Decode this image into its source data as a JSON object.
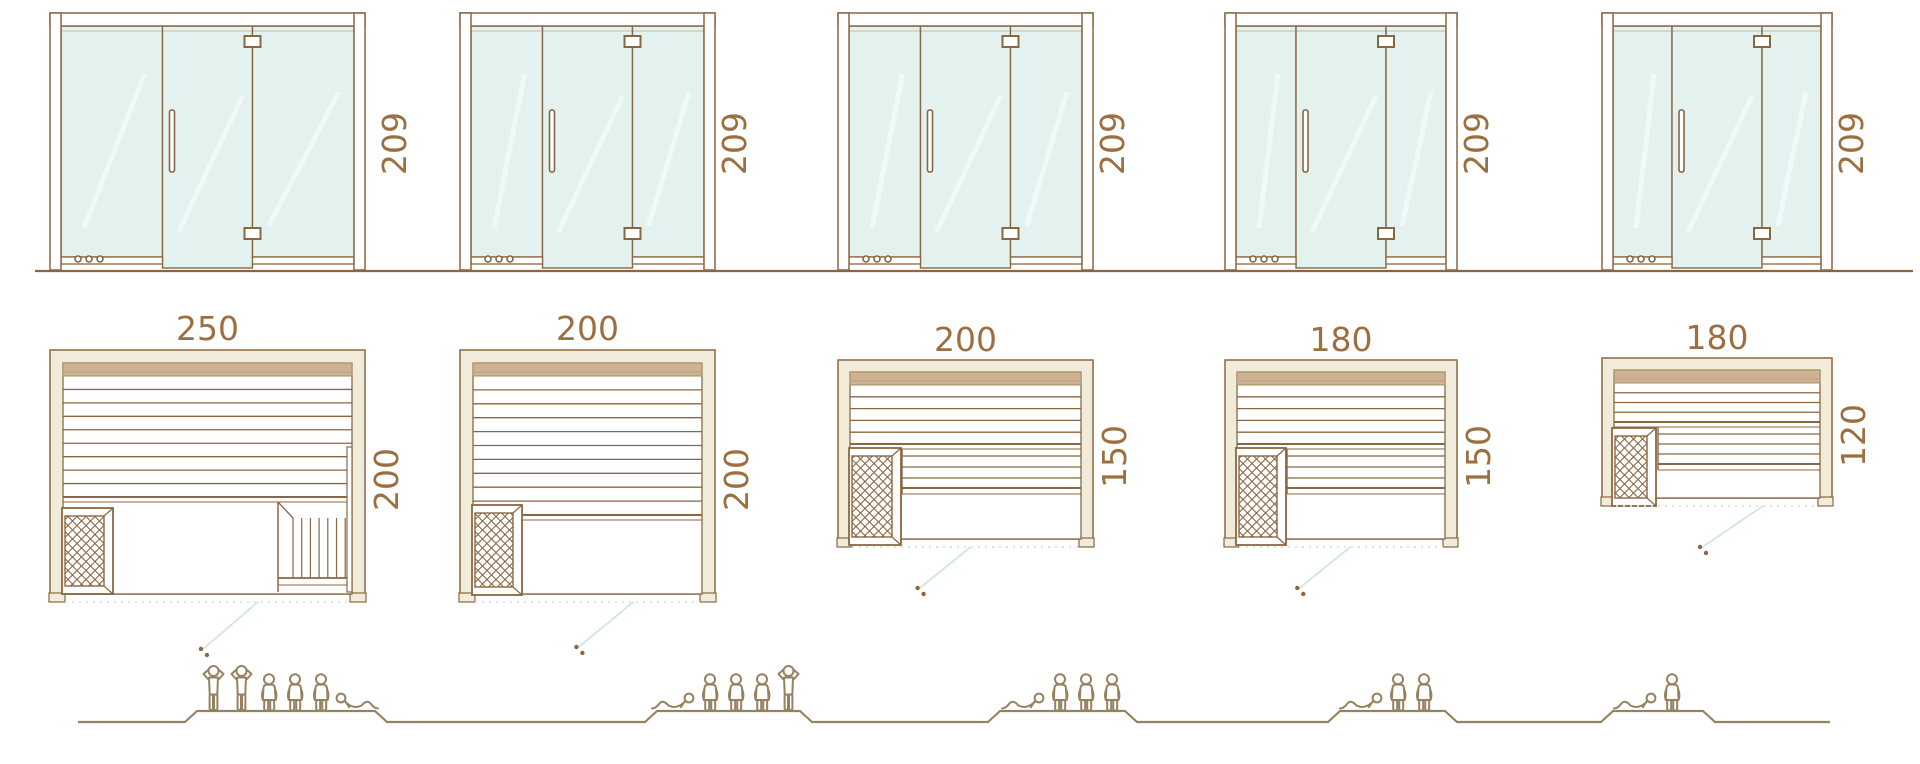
{
  "diagram": {
    "description_labels_only": "sauna size diagram",
    "colors": {
      "line_brown": "#8a6742",
      "dimension_text": "#9c6f41",
      "glass_fill": "#e4f2ef",
      "frame_cream": "#f1ecda",
      "backrest_tan": "#cdb293",
      "door_swing_teal": "#cfe7e2",
      "figure_brown": "#97825f"
    }
  },
  "columns": [
    {
      "height_label": "209",
      "width_label": "250",
      "depth_label": "200",
      "capacity": {
        "standing": 2,
        "sitting": 3,
        "lying": 1
      }
    },
    {
      "height_label": "209",
      "width_label": "200",
      "depth_label": "200",
      "capacity": {
        "standing": 1,
        "sitting": 3,
        "lying": 1
      }
    },
    {
      "height_label": "209",
      "width_label": "200",
      "depth_label": "150",
      "capacity": {
        "standing": 0,
        "sitting": 3,
        "lying": 1
      }
    },
    {
      "height_label": "209",
      "width_label": "180",
      "depth_label": "150",
      "capacity": {
        "standing": 0,
        "sitting": 2,
        "lying": 1
      }
    },
    {
      "height_label": "209",
      "width_label": "180",
      "depth_label": "120",
      "capacity": {
        "standing": 0,
        "sitting": 1,
        "lying": 1
      }
    }
  ]
}
